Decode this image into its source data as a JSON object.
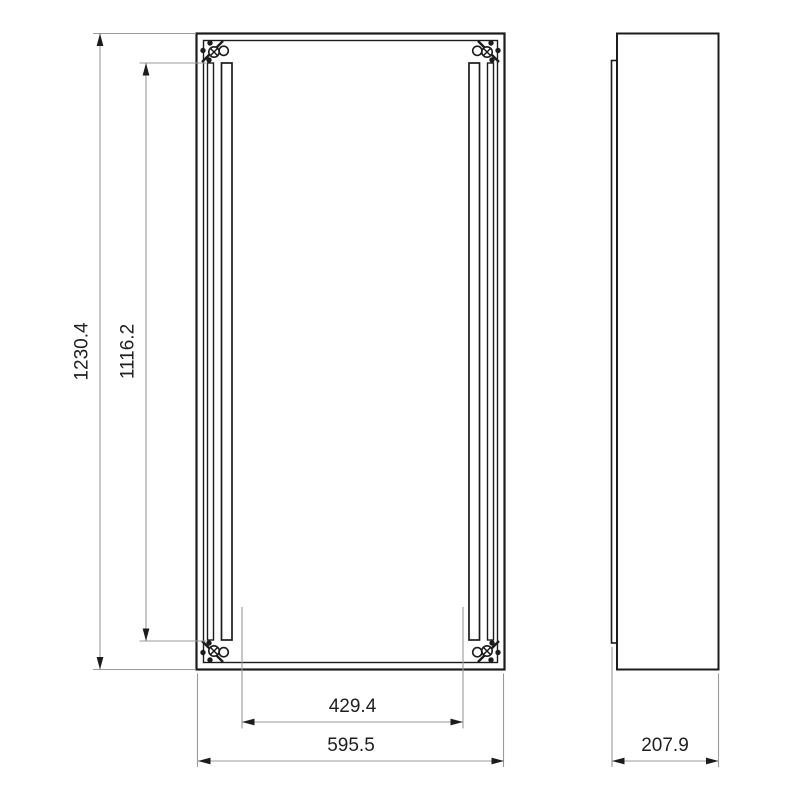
{
  "drawing": {
    "type": "technical-dimension-drawing",
    "background_color": "#ffffff",
    "geometry_color": "#1c1c1c",
    "dimension_line_color": "#9b9b9b",
    "dimension_text_color": "#1f1f1f",
    "dimensions": {
      "overall_height": {
        "value": "1230.4",
        "orientation": "vertical"
      },
      "rail_height": {
        "value": "1116.2",
        "orientation": "vertical"
      },
      "rail_spacing": {
        "value": "429.4",
        "orientation": "horizontal"
      },
      "overall_width": {
        "value": "595.5",
        "orientation": "horizontal"
      },
      "depth": {
        "value": "207.9",
        "orientation": "horizontal"
      }
    }
  }
}
